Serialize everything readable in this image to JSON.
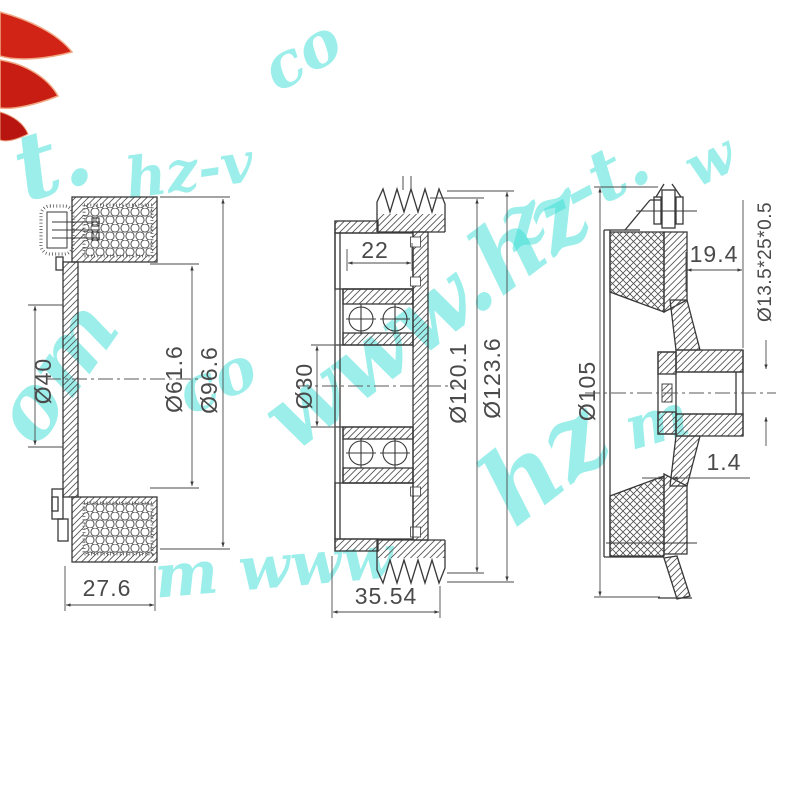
{
  "watermark": {
    "text": "www.hz-vt.com",
    "color": "#3bdfd6",
    "fragments": [
      {
        "text": "t.",
        "x": 2,
        "y": 128,
        "rot": -18,
        "size": 92
      },
      {
        "text": "hz-v",
        "x": 122,
        "y": 152,
        "rot": -8,
        "size": 56
      },
      {
        "text": "co",
        "x": 252,
        "y": 48,
        "rot": -30,
        "size": 62
      },
      {
        "text": "om",
        "x": -22,
        "y": 408,
        "rot": -55,
        "size": 86
      },
      {
        "text": "co",
        "x": 168,
        "y": 368,
        "rot": -24,
        "size": 62
      },
      {
        "text": "www.hz",
        "x": 246,
        "y": 392,
        "rot": -37,
        "size": 92
      },
      {
        "text": "z--t.",
        "x": 486,
        "y": 198,
        "rot": -28,
        "size": 72
      },
      {
        "text": "m www",
        "x": 152,
        "y": 548,
        "rot": -5,
        "size": 60
      },
      {
        "text": "hz",
        "x": 462,
        "y": 462,
        "rot": -38,
        "size": 100
      },
      {
        "text": "m",
        "x": 618,
        "y": 402,
        "rot": -16,
        "size": 60
      },
      {
        "text": "w",
        "x": 676,
        "y": 146,
        "rot": -26,
        "size": 56
      }
    ]
  },
  "logo": {
    "color": "#d22317",
    "edge": "#f0a884"
  },
  "views": {
    "left": {
      "label": "coil-cross-section",
      "dims": {
        "d40": "Ø40",
        "d616": "Ø61.6",
        "d966": "Ø96.6",
        "w276": "27.6"
      }
    },
    "middle": {
      "label": "pulley-cross-section",
      "dims": {
        "w22": "22",
        "d30": "Ø30",
        "d1201": "Ø120.1",
        "d1236": "Ø123.6",
        "w3554": "35.54"
      }
    },
    "right": {
      "label": "hub-cross-section",
      "dims": {
        "w194": "19.4",
        "spline": "Ø13.5*25*0.5",
        "d105": "Ø105",
        "t14": "1.4"
      }
    }
  }
}
